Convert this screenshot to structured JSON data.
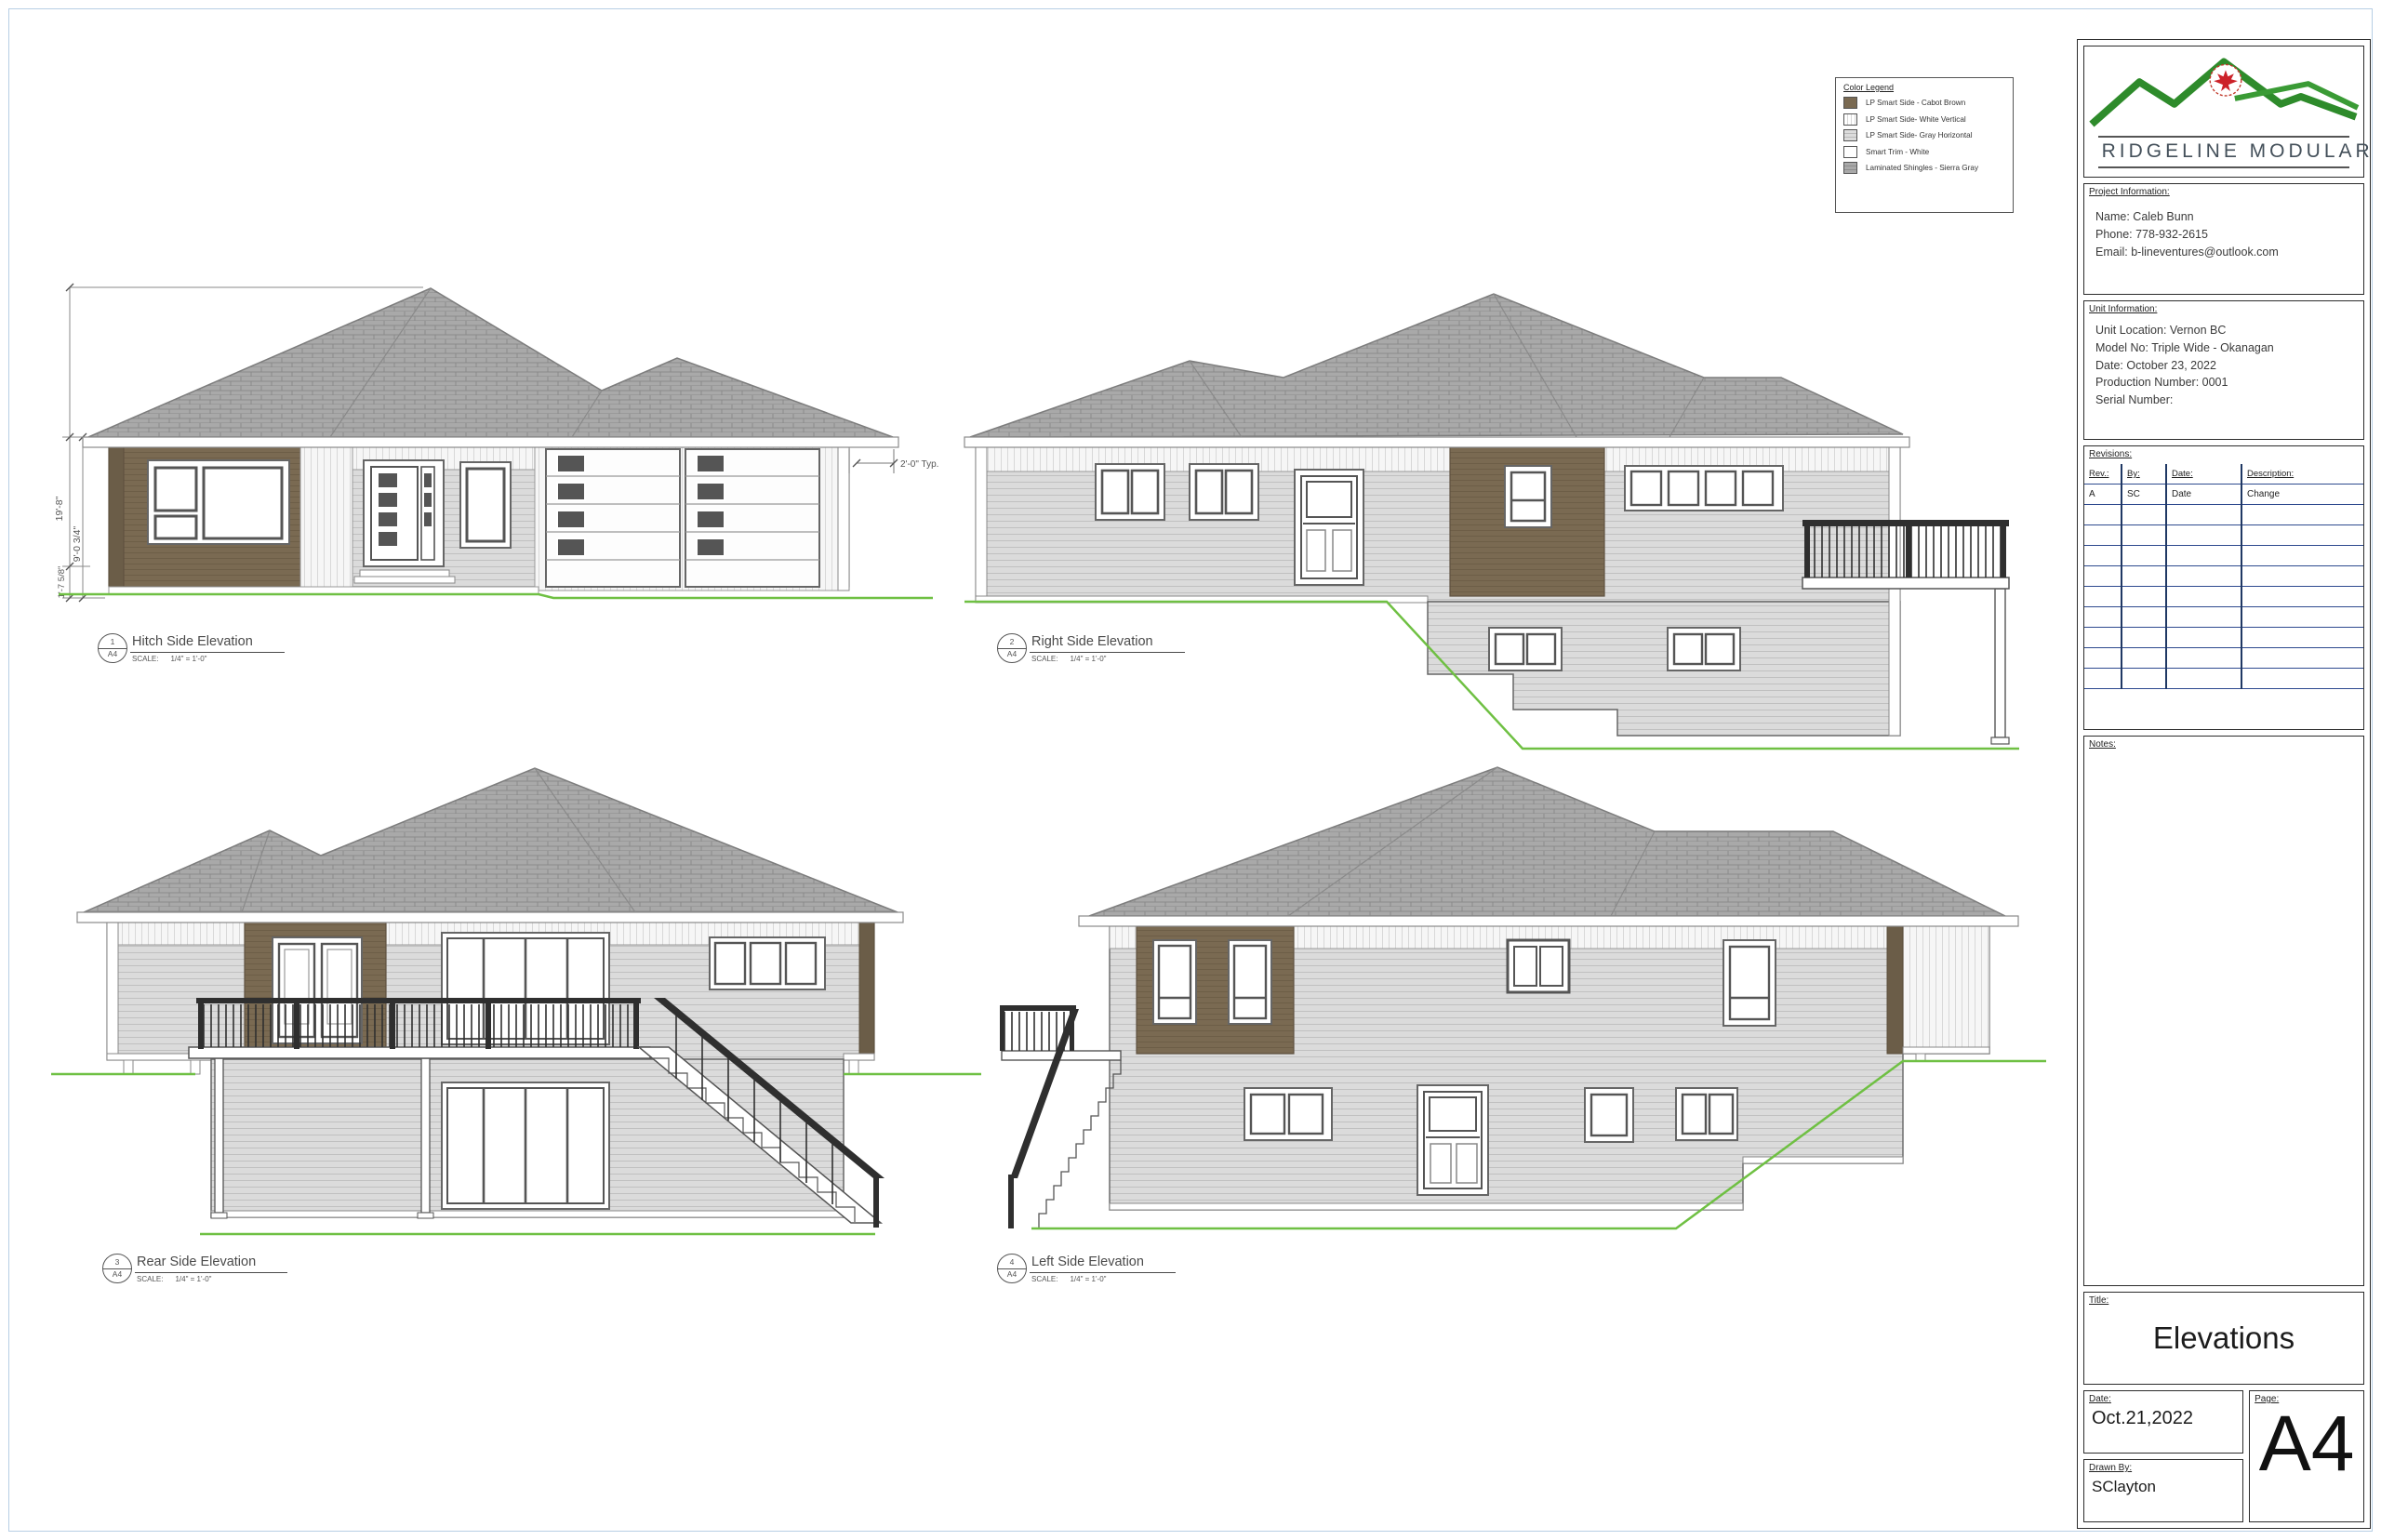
{
  "legend": {
    "title": "Color Legend",
    "items": [
      {
        "swatch": "cabot-brown-swatch",
        "label": "LP Smart Side - Cabot Brown"
      },
      {
        "swatch": "white-vertical-swatch",
        "label": "LP Smart Side- White Vertical"
      },
      {
        "swatch": "gray-horizontal-swatch",
        "label": "LP Smart Side- Gray Horizontal"
      },
      {
        "swatch": "smart-trim-white-swatch",
        "label": "Smart Trim - White"
      },
      {
        "swatch": "sierra-gray-swatch",
        "label": "Laminated Shingles - Sierra Gray"
      }
    ]
  },
  "title_block": {
    "company": "RIDGELINE MODULAR",
    "project_info": {
      "label": "Project Information:",
      "lines": [
        "Name: Caleb Bunn",
        "Phone: 778-932-2615",
        "Email: b-lineventures@outlook.com"
      ]
    },
    "unit_info": {
      "label": "Unit Information:",
      "lines": [
        "Unit Location: Vernon BC",
        "Model No: Triple Wide - Okanagan",
        "Date: October 23, 2022",
        "Production Number: 0001",
        "Serial Number:"
      ]
    },
    "revisions": {
      "label": "Revisions:",
      "columns": [
        "Rev.:",
        "By:",
        "Date:",
        "Description:"
      ],
      "rows": [
        [
          "A",
          "SC",
          "Date",
          "Change"
        ]
      ]
    },
    "notes_label": "Notes:",
    "title": {
      "label": "Title:",
      "value": "Elevations"
    },
    "date": {
      "label": "Date:",
      "value": "Oct.21,2022"
    },
    "drawn_by": {
      "label": "Drawn By:",
      "value": "SClayton"
    },
    "page": {
      "label": "Page:",
      "value": "A4"
    }
  },
  "elevations": [
    {
      "number": "1",
      "sheet_ref": "A4",
      "title": "Hitch Side Elevation",
      "scale_label": "SCALE:",
      "scale_value": "1/4\" = 1'-0\""
    },
    {
      "number": "2",
      "sheet_ref": "A4",
      "title": "Right Side Elevation",
      "scale_label": "SCALE:",
      "scale_value": "1/4\" = 1'-0\""
    },
    {
      "number": "3",
      "sheet_ref": "A4",
      "title": "Rear Side Elevation",
      "scale_label": "SCALE:",
      "scale_value": "1/4\" = 1'-0\""
    },
    {
      "number": "4",
      "sheet_ref": "A4",
      "title": "Left Side Elevation",
      "scale_label": "SCALE:",
      "scale_value": "1/4\" = 1'-0\""
    }
  ],
  "annotations": {
    "overall_height": "19'-8\"",
    "main_floor_height": "9'-0 3/4\"",
    "foundation_height": "1'-7 5/8\"",
    "eave_overhang": "2'-0\" Typ."
  },
  "colors": {
    "cabot_brown": "#7a6a52",
    "shingle_gray": "#a9a9a9",
    "siding_gray": "#dbdbdb",
    "trim_white": "#ffffff",
    "ground_green": "#6fc043",
    "revision_line_blue": "#2e4a8f",
    "logo_green": "#2e8b2b",
    "maple_leaf_red": "#cc2229"
  }
}
